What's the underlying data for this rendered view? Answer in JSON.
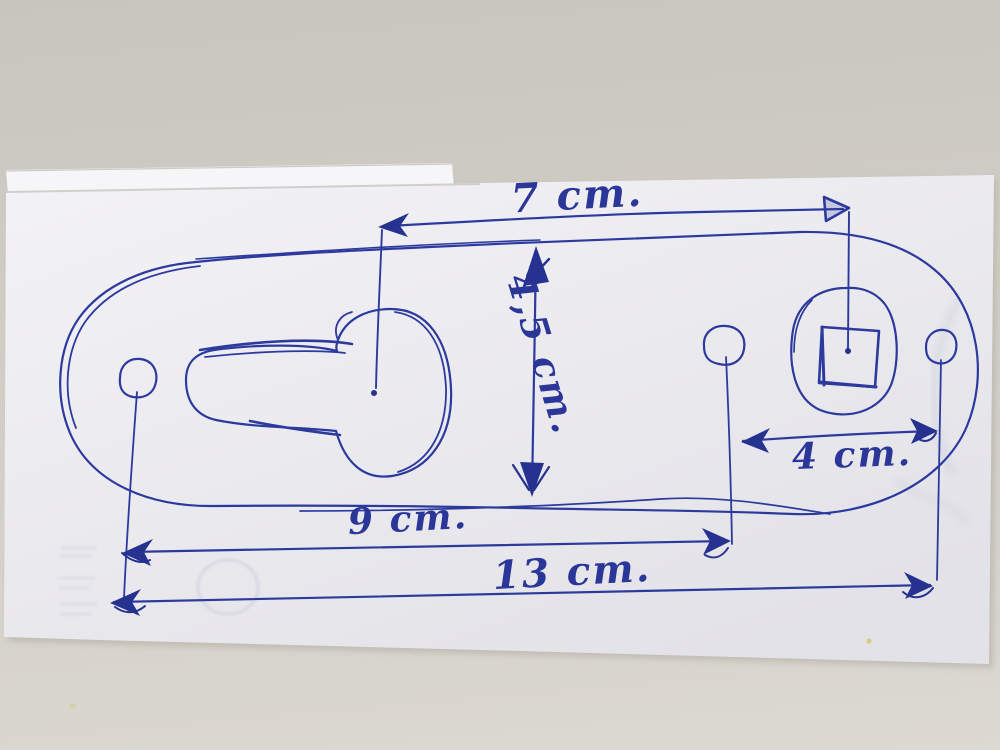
{
  "scene": {
    "description": "Photo of a hand-drawn dimensioned sketch in blue ballpoint pen on a white sheet of paper lying on a beige surface",
    "ink_color": "#2c3a9e",
    "paper_color": "#efeef2",
    "background_color": "#cfccc4"
  },
  "sketch": {
    "shape": "rounded oblong plate with a keyhole-shaped cutout on the left, a square hole in a rounded boss on the right, and three small round holes",
    "dimensions": [
      {
        "id": "top-width",
        "label": "7 cm.",
        "value_cm": 7,
        "measures": "keyhole center to square-hole center"
      },
      {
        "id": "plate-height",
        "label": "4,5 cm.",
        "value_cm": 4.5,
        "measures": "plate height"
      },
      {
        "id": "right-hole-spacing",
        "label": "4 cm.",
        "value_cm": 4,
        "measures": "middle hole to right hole"
      },
      {
        "id": "middle-hole-spacing",
        "label": "9 cm.",
        "value_cm": 9,
        "measures": "left hole to middle hole"
      },
      {
        "id": "outer-hole-spacing",
        "label": "13 cm.",
        "value_cm": 13,
        "measures": "left hole to right hole"
      }
    ]
  }
}
